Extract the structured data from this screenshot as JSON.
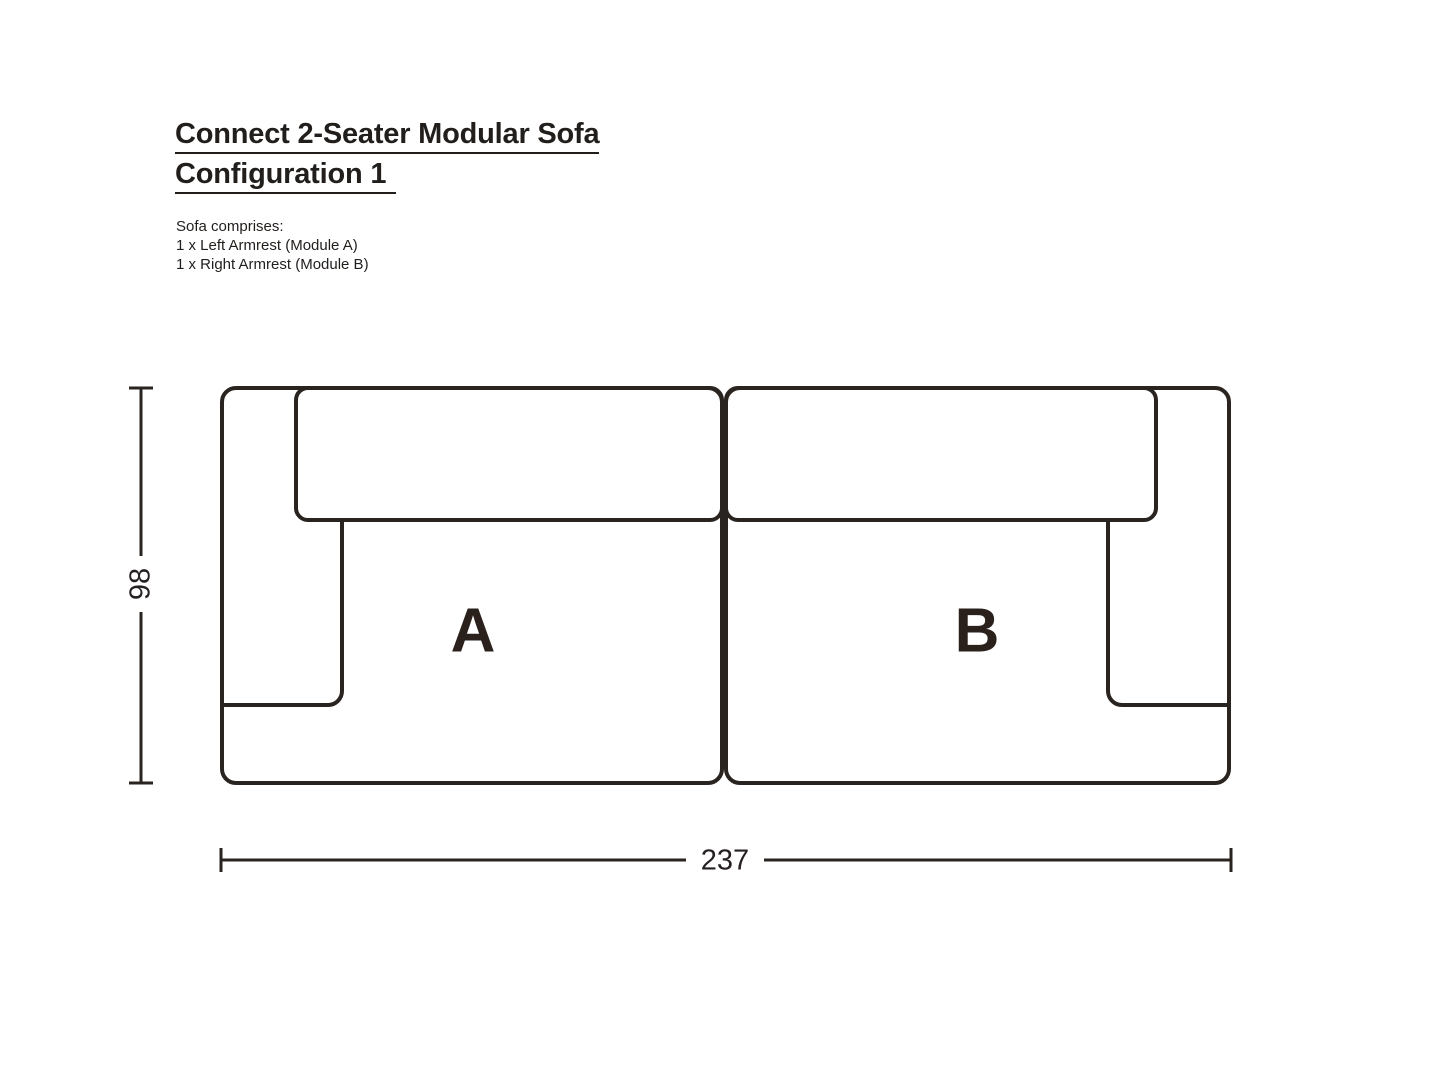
{
  "page": {
    "background": "#ffffff",
    "ink": "#2a2421",
    "text_color": "#211e1c"
  },
  "header": {
    "title_line1": "Connect 2-Seater Modular Sofa",
    "title_line2": "Configuration 1",
    "comprises_heading": "Sofa comprises:",
    "comprises_items": [
      "1 x Left Armrest (Module A)",
      "1 x Right Armrest (Module B)"
    ]
  },
  "diagram": {
    "module_a_label": "A",
    "module_b_label": "B",
    "width_value": "237",
    "depth_value": "98"
  }
}
